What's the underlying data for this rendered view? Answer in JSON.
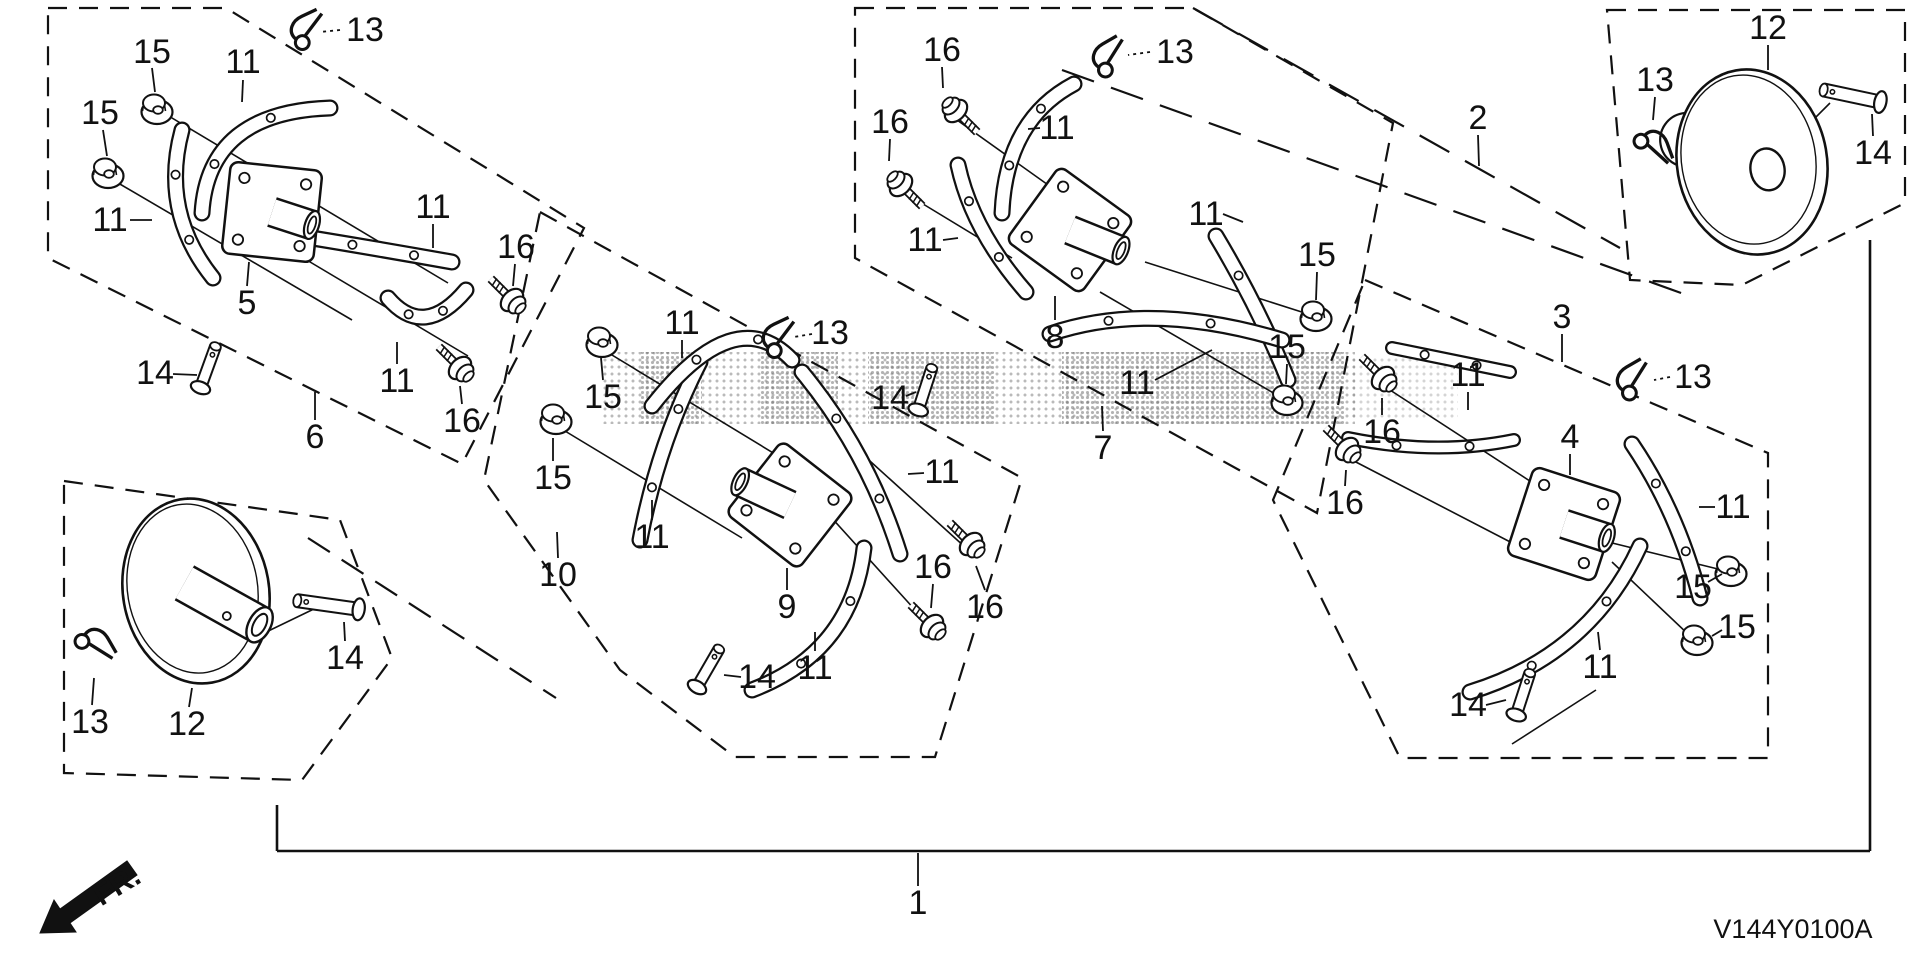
{
  "meta": {
    "background": "#ffffff",
    "line_color": "#111111",
    "watermark_color": "#666666"
  },
  "footer": {
    "diagram_code": "V144Y0100A",
    "fr_label": "FR."
  },
  "boxes": [
    {
      "name": "group-box-6",
      "points": "48,8 226,8 584,228 462,464 48,258"
    },
    {
      "name": "group-box-10",
      "points": "540,212 1022,478 935,757 735,757 620,670 484,480"
    },
    {
      "name": "group-box-7",
      "points": "855,8 1193,8 1393,123 1317,513 855,258"
    },
    {
      "name": "group-box-3",
      "points": "1365,280 1768,453 1768,758 1400,758 1273,500"
    },
    {
      "name": "group-box-12-left",
      "points": "64,481 340,520 392,658 302,780 64,773"
    },
    {
      "name": "group-box-12-right",
      "points": "1607,10 1905,10 1905,203 1742,285 1630,280"
    }
  ],
  "lines": [
    {
      "x1": 277,
      "y1": 805,
      "x2": 277,
      "y2": 851,
      "d": null,
      "w": 2.6
    },
    {
      "x1": 277,
      "y1": 851,
      "x2": 1870,
      "y2": 851,
      "d": null,
      "w": 2.6
    },
    {
      "x1": 1870,
      "y1": 240,
      "x2": 1870,
      "y2": 851,
      "d": null,
      "w": 2.6
    },
    {
      "x1": 1193,
      "y1": 8,
      "x2": 1620,
      "y2": 248,
      "d": "34 18",
      "w": 2.2
    },
    {
      "x1": 1062,
      "y1": 70,
      "x2": 1695,
      "y2": 298,
      "d": "34 18",
      "w": 2.2
    },
    {
      "x1": 308,
      "y1": 538,
      "x2": 556,
      "y2": 698,
      "d": "26 14",
      "w": 2.2
    }
  ],
  "axes": [
    [
      162,
      112,
      448,
      283
    ],
    [
      113,
      180,
      352,
      320
    ],
    [
      300,
      256,
      468,
      356
    ],
    [
      607,
      352,
      798,
      468
    ],
    [
      560,
      428,
      742,
      538
    ],
    [
      860,
      452,
      966,
      548
    ],
    [
      820,
      505,
      926,
      622
    ],
    [
      950,
      115,
      1058,
      192
    ],
    [
      900,
      190,
      1012,
      258
    ],
    [
      1145,
      262,
      1308,
      314
    ],
    [
      1100,
      292,
      1282,
      398
    ],
    [
      1390,
      390,
      1556,
      498
    ],
    [
      1352,
      460,
      1518,
      546
    ],
    [
      1600,
      540,
      1722,
      570
    ],
    [
      1612,
      562,
      1690,
      636
    ],
    [
      1512,
      744,
      1596,
      690
    ],
    [
      258,
      636,
      318,
      607
    ],
    [
      1790,
      143,
      1830,
      103
    ]
  ],
  "labels": [
    {
      "t": "13",
      "x": 365,
      "y": 30,
      "l": [
        340,
        30,
        320,
        32
      ],
      "dot": true
    },
    {
      "t": "15",
      "x": 152,
      "y": 52,
      "l": [
        152,
        68,
        155,
        92
      ]
    },
    {
      "t": "11",
      "x": 243,
      "y": 62,
      "l": [
        243,
        80,
        242,
        102
      ]
    },
    {
      "t": "15",
      "x": 100,
      "y": 113,
      "l": [
        103,
        130,
        107,
        156
      ]
    },
    {
      "t": "11",
      "x": 110,
      "y": 220,
      "l": [
        130,
        220,
        152,
        220
      ]
    },
    {
      "t": "5",
      "x": 247,
      "y": 303,
      "l": [
        247,
        286,
        249,
        262
      ]
    },
    {
      "t": "11",
      "x": 433,
      "y": 207,
      "l": [
        433,
        224,
        433,
        248
      ]
    },
    {
      "t": "16",
      "x": 516,
      "y": 247,
      "l": [
        515,
        264,
        513,
        286
      ]
    },
    {
      "t": "14",
      "x": 155,
      "y": 373,
      "l": [
        173,
        374,
        197,
        375
      ]
    },
    {
      "t": "6",
      "x": 315,
      "y": 437,
      "l": [
        315,
        420,
        315,
        392
      ]
    },
    {
      "t": "16",
      "x": 462,
      "y": 421,
      "l": [
        462,
        404,
        460,
        386
      ]
    },
    {
      "t": "11",
      "x": 397,
      "y": 381,
      "l": [
        397,
        364,
        397,
        342
      ]
    },
    {
      "t": "15",
      "x": 603,
      "y": 397,
      "l": [
        603,
        380,
        601,
        358
      ]
    },
    {
      "t": "15",
      "x": 553,
      "y": 478,
      "l": [
        553,
        461,
        553,
        438
      ]
    },
    {
      "t": "11",
      "x": 682,
      "y": 323,
      "l": [
        682,
        340,
        682,
        358
      ]
    },
    {
      "t": "13",
      "x": 830,
      "y": 333,
      "l": [
        812,
        334,
        794,
        337
      ],
      "dot": true
    },
    {
      "t": "11",
      "x": 942,
      "y": 472,
      "l": [
        924,
        473,
        908,
        474
      ]
    },
    {
      "t": "11",
      "x": 652,
      "y": 537,
      "l": [
        652,
        520,
        652,
        500
      ]
    },
    {
      "t": "9",
      "x": 787,
      "y": 607,
      "l": [
        787,
        590,
        787,
        568
      ]
    },
    {
      "t": "11",
      "x": 815,
      "y": 668,
      "l": [
        815,
        651,
        815,
        632
      ]
    },
    {
      "t": "14",
      "x": 757,
      "y": 677,
      "l": [
        741,
        677,
        724,
        675
      ]
    },
    {
      "t": "16",
      "x": 933,
      "y": 567,
      "l": [
        933,
        584,
        931,
        608
      ]
    },
    {
      "t": "16",
      "x": 985,
      "y": 607,
      "l": [
        985,
        590,
        976,
        566
      ]
    },
    {
      "t": "10",
      "x": 558,
      "y": 575,
      "l": [
        558,
        558,
        557,
        532
      ]
    },
    {
      "t": "16",
      "x": 942,
      "y": 50,
      "l": [
        942,
        67,
        943,
        88
      ]
    },
    {
      "t": "13",
      "x": 1175,
      "y": 52,
      "l": [
        1150,
        52,
        1128,
        55
      ],
      "dot": true
    },
    {
      "t": "16",
      "x": 890,
      "y": 122,
      "l": [
        890,
        139,
        889,
        161
      ]
    },
    {
      "t": "11",
      "x": 1057,
      "y": 128,
      "l": [
        1040,
        128,
        1028,
        129
      ]
    },
    {
      "t": "11",
      "x": 925,
      "y": 240,
      "l": [
        943,
        240,
        958,
        238
      ]
    },
    {
      "t": "8",
      "x": 1055,
      "y": 337,
      "l": [
        1055,
        320,
        1055,
        296
      ]
    },
    {
      "t": "15",
      "x": 1317,
      "y": 255,
      "l": [
        1317,
        272,
        1316,
        300
      ]
    },
    {
      "t": "15",
      "x": 1287,
      "y": 347,
      "l": [
        1287,
        364,
        1286,
        384
      ]
    },
    {
      "t": "14",
      "x": 890,
      "y": 398,
      "l": [
        906,
        396,
        916,
        392
      ]
    },
    {
      "t": "7",
      "x": 1103,
      "y": 448,
      "l": [
        1103,
        431,
        1102,
        406
      ]
    },
    {
      "t": "11",
      "x": 1206,
      "y": 214,
      "l": [
        1223,
        214,
        1243,
        222
      ]
    },
    {
      "t": "2",
      "x": 1478,
      "y": 118,
      "l": [
        1478,
        135,
        1479,
        166
      ]
    },
    {
      "t": "3",
      "x": 1562,
      "y": 317,
      "l": [
        1562,
        334,
        1562,
        362
      ]
    },
    {
      "t": "13",
      "x": 1693,
      "y": 377,
      "l": [
        1670,
        377,
        1654,
        380
      ],
      "dot": true
    },
    {
      "t": "11",
      "x": 1468,
      "y": 375,
      "l": [
        1468,
        392,
        1468,
        410
      ]
    },
    {
      "t": "11",
      "x": 1137,
      "y": 383,
      "l": [
        1155,
        380,
        1212,
        350
      ]
    },
    {
      "t": "4",
      "x": 1570,
      "y": 437,
      "l": [
        1570,
        454,
        1570,
        475
      ]
    },
    {
      "t": "16",
      "x": 1382,
      "y": 432,
      "l": [
        1382,
        415,
        1382,
        398
      ]
    },
    {
      "t": "16",
      "x": 1345,
      "y": 503,
      "l": [
        1345,
        486,
        1346,
        470
      ]
    },
    {
      "t": "11",
      "x": 1733,
      "y": 507,
      "l": [
        1715,
        507,
        1699,
        507
      ]
    },
    {
      "t": "15",
      "x": 1693,
      "y": 587,
      "l": [
        1708,
        582,
        1722,
        574
      ]
    },
    {
      "t": "15",
      "x": 1737,
      "y": 627,
      "l": [
        1722,
        630,
        1712,
        636
      ]
    },
    {
      "t": "11",
      "x": 1600,
      "y": 667,
      "l": [
        1600,
        650,
        1598,
        632
      ]
    },
    {
      "t": "14",
      "x": 1468,
      "y": 705,
      "l": [
        1486,
        705,
        1506,
        700
      ]
    },
    {
      "t": "13",
      "x": 90,
      "y": 722,
      "l": [
        92,
        705,
        94,
        678
      ]
    },
    {
      "t": "12",
      "x": 187,
      "y": 724,
      "l": [
        189,
        707,
        192,
        688
      ]
    },
    {
      "t": "14",
      "x": 345,
      "y": 658,
      "l": [
        345,
        641,
        344,
        622
      ]
    },
    {
      "t": "12",
      "x": 1768,
      "y": 28,
      "l": [
        1768,
        45,
        1768,
        70
      ]
    },
    {
      "t": "13",
      "x": 1655,
      "y": 80,
      "l": [
        1655,
        97,
        1653,
        120
      ]
    },
    {
      "t": "14",
      "x": 1873,
      "y": 153,
      "l": [
        1873,
        136,
        1872,
        114
      ]
    },
    {
      "t": "1",
      "x": 918,
      "y": 903,
      "l": [
        918,
        886,
        918,
        853
      ]
    }
  ],
  "plates": [
    {
      "ref": "5",
      "x": 272,
      "y": 212,
      "rot": 6,
      "hub": {
        "angle": 18,
        "len": 42
      }
    },
    {
      "ref": "9",
      "x": 790,
      "y": 505,
      "rot": 38,
      "hub": {
        "angle": -155,
        "len": 55
      }
    },
    {
      "ref": "8",
      "x": 1070,
      "y": 230,
      "rot": 36,
      "hub": {
        "angle": 22,
        "len": 55
      }
    },
    {
      "ref": "4",
      "x": 1564,
      "y": 524,
      "rot": 18,
      "hub": {
        "angle": 18,
        "len": 45
      }
    }
  ],
  "blades": [
    {
      "p": [
        [
          202,
          213
        ],
        [
          208,
          112
        ],
        [
          330,
          108
        ]
      ],
      "w": 17
    },
    {
      "p": [
        [
          182,
          130
        ],
        [
          160,
          212
        ],
        [
          213,
          278
        ]
      ],
      "w": 17
    },
    {
      "p": [
        [
          312,
          238
        ],
        [
          385,
          250
        ],
        [
          452,
          262
        ]
      ],
      "w": 17
    },
    {
      "p": [
        [
          388,
          298
        ],
        [
          424,
          340
        ],
        [
          466,
          290
        ]
      ],
      "w": 17
    },
    {
      "p": [
        [
          700,
          362
        ],
        [
          658,
          444
        ],
        [
          640,
          540
        ]
      ],
      "w": 17
    },
    {
      "p": [
        [
          652,
          406
        ],
        [
          735,
          300
        ],
        [
          792,
          360
        ]
      ],
      "w": 17
    },
    {
      "p": [
        [
          802,
          372
        ],
        [
          868,
          452
        ],
        [
          900,
          554
        ]
      ],
      "w": 17
    },
    {
      "p": [
        [
          864,
          548
        ],
        [
          852,
          652
        ],
        [
          752,
          690
        ]
      ],
      "w": 17
    },
    {
      "p": [
        [
          1002,
          213
        ],
        [
          1006,
          120
        ],
        [
          1074,
          84
        ]
      ],
      "w": 17
    },
    {
      "p": [
        [
          958,
          165
        ],
        [
          972,
          230
        ],
        [
          1026,
          292
        ]
      ],
      "w": 17
    },
    {
      "p": [
        [
          1216,
          236
        ],
        [
          1258,
          306
        ],
        [
          1288,
          380
        ]
      ],
      "w": 17
    },
    {
      "p": [
        [
          1050,
          334
        ],
        [
          1150,
          300
        ],
        [
          1282,
          340
        ]
      ],
      "w": 17
    },
    {
      "p": [
        [
          1392,
          348
        ],
        [
          1450,
          360
        ],
        [
          1510,
          372
        ]
      ],
      "w": 14
    },
    {
      "p": [
        [
          1348,
          438
        ],
        [
          1436,
          456
        ],
        [
          1514,
          440
        ]
      ],
      "w": 14
    },
    {
      "p": [
        [
          1632,
          444
        ],
        [
          1678,
          512
        ],
        [
          1700,
          598
        ]
      ],
      "w": 17
    },
    {
      "p": [
        [
          1640,
          546
        ],
        [
          1590,
          655
        ],
        [
          1470,
          692
        ]
      ],
      "w": 17
    }
  ],
  "nuts": [
    {
      "x": 157,
      "y": 108
    },
    {
      "x": 108,
      "y": 172
    },
    {
      "x": 602,
      "y": 341
    },
    {
      "x": 556,
      "y": 418
    },
    {
      "x": 1316,
      "y": 315
    },
    {
      "x": 1287,
      "y": 399
    },
    {
      "x": 1731,
      "y": 570
    },
    {
      "x": 1697,
      "y": 639
    }
  ],
  "bolts": [
    {
      "x": 512,
      "y": 300,
      "rot": -135
    },
    {
      "x": 460,
      "y": 368,
      "rot": -135
    },
    {
      "x": 932,
      "y": 626,
      "rot": -135
    },
    {
      "x": 971,
      "y": 544,
      "rot": -135
    },
    {
      "x": 956,
      "y": 111,
      "rot": 45
    },
    {
      "x": 901,
      "y": 185,
      "rot": 45
    },
    {
      "x": 1383,
      "y": 378,
      "rot": -135
    },
    {
      "x": 1347,
      "y": 449,
      "rot": -135
    }
  ],
  "pins": [
    {
      "x": 208,
      "y": 367,
      "rot": -70,
      "len": 44,
      "w": 13
    },
    {
      "x": 708,
      "y": 668,
      "rot": -60,
      "len": 44,
      "w": 13
    },
    {
      "x": 925,
      "y": 389,
      "rot": -72,
      "len": 44,
      "w": 13
    },
    {
      "x": 1523,
      "y": 694,
      "rot": -72,
      "len": 44,
      "w": 13
    },
    {
      "x": 328,
      "y": 605,
      "rot": 188,
      "len": 62,
      "w": 15
    },
    {
      "x": 1852,
      "y": 96,
      "rot": 192,
      "len": 58,
      "w": 15
    }
  ],
  "cotters": [
    {
      "x": 308,
      "y": 30,
      "rot": -25
    },
    {
      "x": 1110,
      "y": 57,
      "rot": -30
    },
    {
      "x": 780,
      "y": 338,
      "rot": -25
    },
    {
      "x": 1634,
      "y": 380,
      "rot": -30
    },
    {
      "x": 95,
      "y": 646,
      "rot": 60
    },
    {
      "x": 1653,
      "y": 148,
      "rot": 70
    }
  ],
  "discs": [
    {
      "ref": "12",
      "cx": 196,
      "cy": 591,
      "rx": 73,
      "ry": 93,
      "rot": -10,
      "tube": {
        "angle": 38,
        "len": 72,
        "w": 40
      },
      "stub": {
        "dx": -22,
        "dy": -30,
        "r": 24
      },
      "hole": null,
      "smallHole": {
        "dx": 26,
        "dy": 30
      }
    },
    {
      "ref": "12",
      "cx": 1752,
      "cy": 162,
      "rx": 75,
      "ry": 93,
      "rot": -10,
      "tube": null,
      "stub": {
        "dx": -60,
        "dy": -33,
        "r": 27
      },
      "hole": {
        "dx": 14,
        "dy": 10,
        "rx": 17,
        "ry": 21
      },
      "smallHole": null
    }
  ],
  "watermark": {
    "bands": [
      {
        "x": 600,
        "y": 352,
        "w": 755,
        "h": 72,
        "p": "dots7",
        "o": 0.45
      },
      {
        "x": 640,
        "y": 352,
        "w": 62,
        "h": 72,
        "p": "dots5",
        "o": 0.5
      },
      {
        "x": 760,
        "y": 352,
        "w": 78,
        "h": 72,
        "p": "dots5",
        "o": 0.5
      },
      {
        "x": 868,
        "y": 352,
        "w": 128,
        "h": 72,
        "p": "dots5",
        "o": 0.5
      },
      {
        "x": 1062,
        "y": 352,
        "w": 284,
        "h": 72,
        "p": "dots5",
        "o": 0.5
      },
      {
        "x": 1352,
        "y": 356,
        "w": 106,
        "h": 64,
        "p": "dots7",
        "o": 0.28
      }
    ]
  },
  "fr_arrow": {
    "points": "40,933 76,932 70,923 137,875 127,861 60,909 54,900",
    "tx": 100,
    "ty": 902,
    "trot": -31
  },
  "code_pos": {
    "x": 1793,
    "y": 935
  }
}
